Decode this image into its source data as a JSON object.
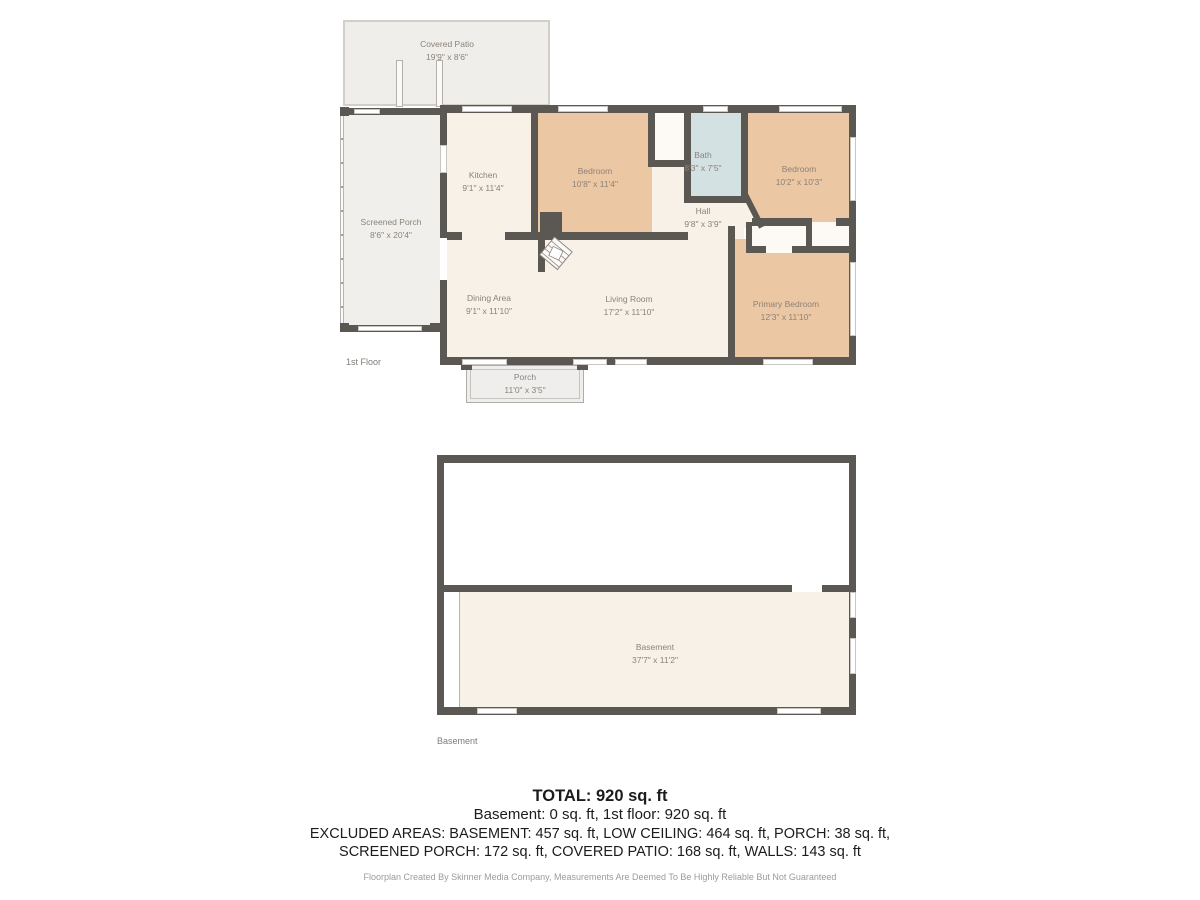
{
  "colors": {
    "wall": "#5b5753",
    "room_cream": "#f8f1e7",
    "room_tan": "#ecc7a3",
    "bath_blue": "#d3e1e2",
    "outdoor_gray": "#efeeeb",
    "closet_white": "#fdfaf5",
    "label_gray": "#8c8379",
    "text_dark": "#1c1c1c",
    "footer_gray": "#9b9b9b"
  },
  "floor1": {
    "label": "1st Floor",
    "rooms": {
      "covered_patio": {
        "name": "Covered Patio",
        "dims": "19'9\" x 8'6\""
      },
      "screened_porch": {
        "name": "Screened Porch",
        "dims": "8'6\" x 20'4\""
      },
      "kitchen": {
        "name": "Kitchen",
        "dims": "9'1\" x 11'4\""
      },
      "bedroom_top": {
        "name": "Bedroom",
        "dims": "10'8\" x 11'4\""
      },
      "bath": {
        "name": "Bath",
        "dims": "8'3\" x 7'5\""
      },
      "bedroom_right": {
        "name": "Bedroom",
        "dims": "10'2\" x 10'3\""
      },
      "hall": {
        "name": "Hall",
        "dims": "9'8\" x 3'9\""
      },
      "dining": {
        "name": "Dining Area",
        "dims": "9'1\" x 11'10\""
      },
      "living": {
        "name": "Living Room",
        "dims": "17'2\" x 11'10\""
      },
      "primary": {
        "name": "Primary Bedroom",
        "dims": "12'3\" x 11'10\""
      },
      "porch": {
        "name": "Porch",
        "dims": "11'0\" x 3'5\""
      }
    }
  },
  "basement": {
    "label": "Basement",
    "rooms": {
      "basement_room": {
        "name": "Basement",
        "dims": "37'7\" x 11'2\""
      }
    }
  },
  "summary": {
    "total": "TOTAL: 920 sq. ft",
    "floors": "Basement: 0 sq. ft, 1st floor: 920 sq. ft",
    "excluded_1": "EXCLUDED AREAS: BASEMENT: 457 sq. ft, LOW CEILING: 464 sq. ft, PORCH: 38 sq. ft,",
    "excluded_2": "SCREENED PORCH: 172 sq. ft, COVERED PATIO: 168 sq. ft, WALLS: 143 sq. ft",
    "disclaimer": "Floorplan Created By Skinner Media Company, Measurements Are Deemed To Be Highly Reliable But Not Guaranteed"
  }
}
